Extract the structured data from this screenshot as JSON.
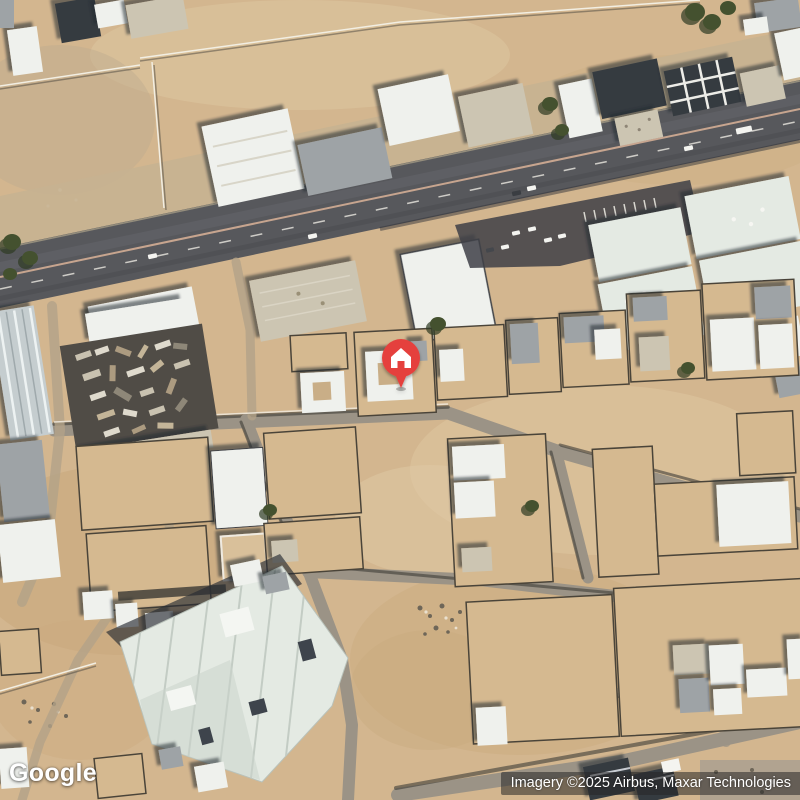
{
  "map": {
    "kind": "satellite imagery",
    "watermark": {
      "label": "Google"
    },
    "attribution": {
      "label": "Imagery ©2025 Airbus, Maxar Technologies"
    },
    "marker": {
      "name": "home place marker",
      "icon": "home-icon",
      "pin_color": "#E5413C",
      "glyph_color": "#FFFFFF",
      "position_px": {
        "x": 401,
        "y": 358
      }
    },
    "palette": {
      "sand": "#D3B68F",
      "asphalt": "#57585C",
      "minor_road": "#9B9386",
      "roof_white": "#EFF1ED",
      "roof_gray": "#9EA3A6",
      "roof_dark": "#363A41",
      "roof_pale": "#E4EAE3",
      "shadow": "#2B2F38",
      "vegetation": "#44512F",
      "marker_red": "#E5413C"
    }
  }
}
